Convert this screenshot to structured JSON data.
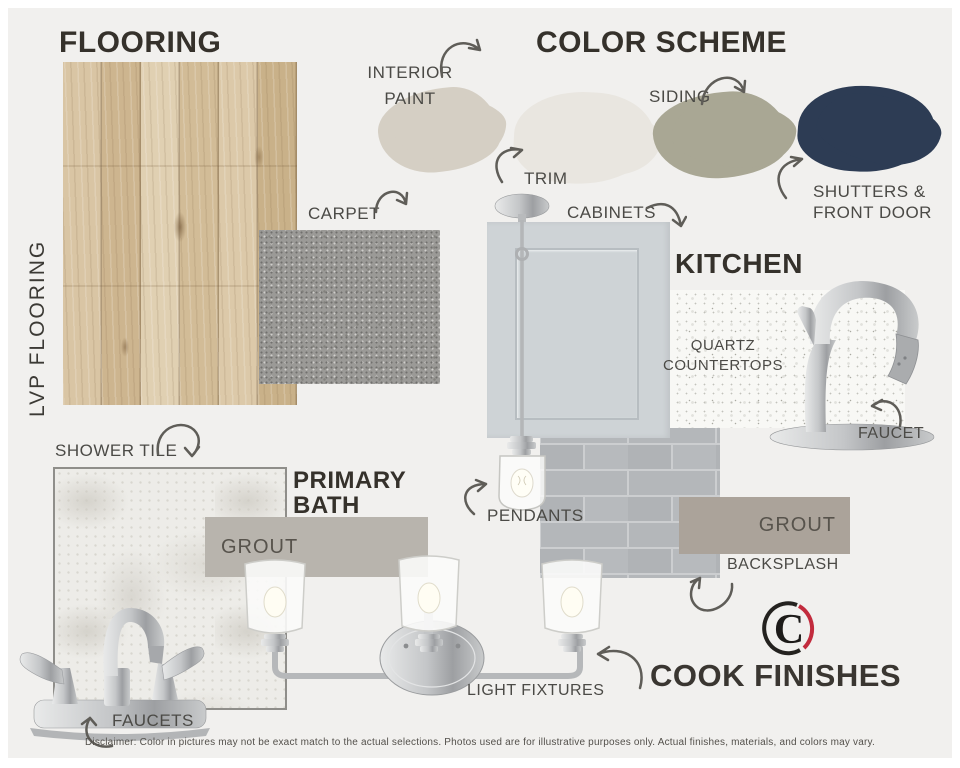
{
  "board": {
    "background_color": "#f1f0ee",
    "frame_color": "#ffffff",
    "heading_color": "#35312b",
    "label_color": "#4b4a46",
    "arrow_color": "#5f5d58"
  },
  "flooring": {
    "title": "FLOORING",
    "vertical_label": "LVP FLOORING",
    "carpet_label": "CARPET"
  },
  "color_scheme": {
    "title": "COLOR SCHEME",
    "swatches": [
      {
        "id": "interior-paint",
        "label_lines": [
          "INTERIOR",
          "PAINT"
        ],
        "color": "#d5cfc4"
      },
      {
        "id": "trim",
        "label_lines": [
          "TRIM"
        ],
        "color": "#e9e6e0"
      },
      {
        "id": "siding",
        "label_lines": [
          "SIDING"
        ],
        "color": "#a9a794"
      },
      {
        "id": "shutters-front-door",
        "label_lines": [
          "SHUTTERS &",
          "FRONT DOOR"
        ],
        "color": "#2d3c54"
      }
    ]
  },
  "kitchen": {
    "title": "KITCHEN",
    "cabinets_label": "CABINETS",
    "cabinet_color": "#ced3d6",
    "quartz_label_lines": [
      "QUARTZ",
      "COUNTERTOPS"
    ],
    "faucet_label": "FAUCET",
    "pendants_label": "PENDANTS",
    "grout_label": "GROUT",
    "grout_bar_color": "#aba39a",
    "backsplash_label": "BACKSPLASH"
  },
  "primary_bath": {
    "title_lines": [
      "PRIMARY",
      "BATH"
    ],
    "shower_tile_label": "SHOWER TILE",
    "grout_label": "GROUT",
    "grout_bar_color": "#b8b4ad",
    "faucets_label": "FAUCETS",
    "light_fixtures_label": "LIGHT FIXTURES"
  },
  "brand": {
    "name": "COOK FINISHES",
    "logo_letter": "C",
    "logo_accent_color": "#c22b3d"
  },
  "disclaimer": "Disclaimer: Color in pictures may not be exact match to the actual selections. Photos used are for illustrative purposes only. Actual finishes, materials, and colors may vary."
}
